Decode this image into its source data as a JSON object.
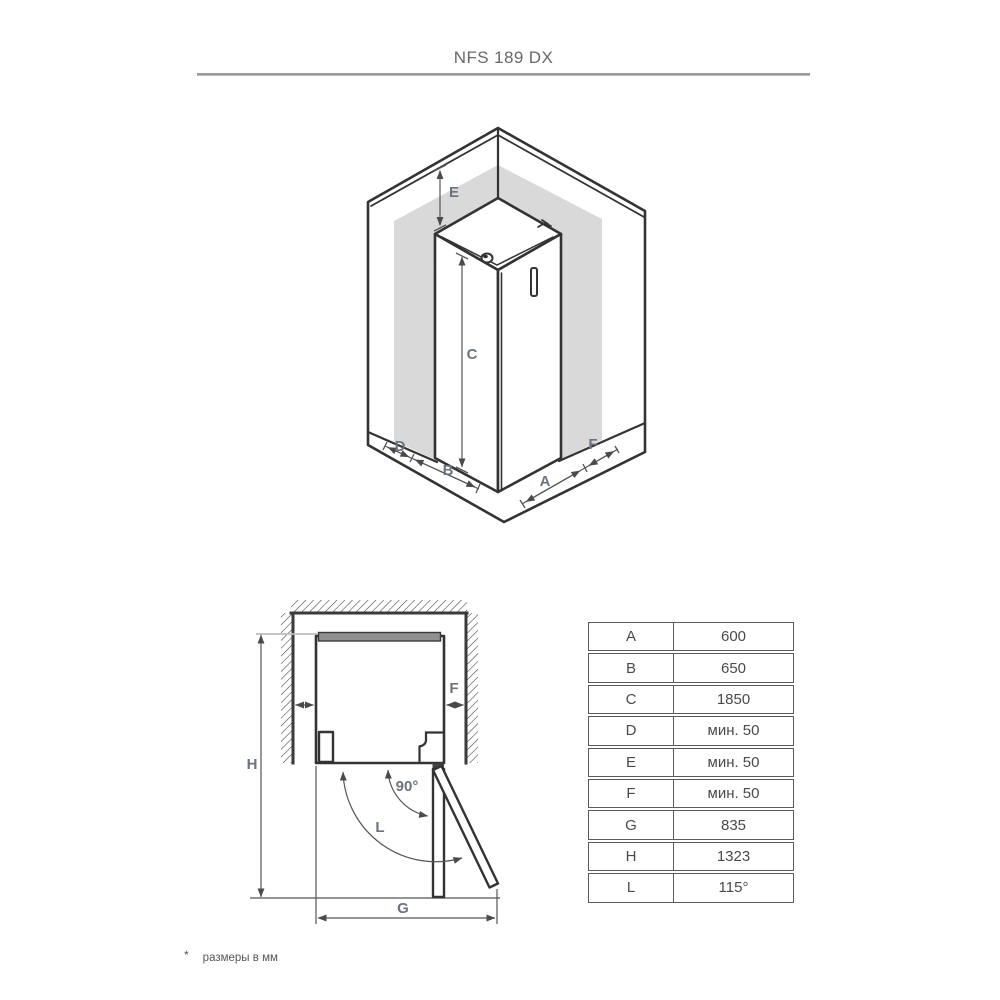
{
  "header": {
    "title": "NFS 189 DX"
  },
  "iso_view": {
    "dim_labels": {
      "E": "E",
      "C": "C",
      "D": "D",
      "B": "B",
      "A": "A",
      "F": "F"
    }
  },
  "plan_view": {
    "dim_labels": {
      "H": "H",
      "F": "F",
      "angle": "90°",
      "swing": "L",
      "G": "G"
    }
  },
  "dimensions_table": {
    "rows": [
      {
        "key": "A",
        "value": "600"
      },
      {
        "key": "B",
        "value": "650"
      },
      {
        "key": "C",
        "value": "1850"
      },
      {
        "key": "D",
        "value": "мин. 50"
      },
      {
        "key": "E",
        "value": "мин. 50"
      },
      {
        "key": "F",
        "value": "мин. 50"
      },
      {
        "key": "G",
        "value": "835"
      },
      {
        "key": "H",
        "value": "1323"
      },
      {
        "key": "L",
        "value": "115°"
      }
    ]
  },
  "footnote": {
    "mark": "*",
    "text": "размеры в мм"
  },
  "colors": {
    "line": "#333333",
    "wall": "#3a3a3a",
    "dim": "#555555",
    "label": "#6b7380",
    "shadow": "#d9d9d9",
    "title": "#686868",
    "tabletext": "#4a4a4a",
    "tableborder": "#5a5a5a",
    "rule": "#a3a3a3",
    "refline": "#bdbdbd",
    "bar": "#909090"
  }
}
